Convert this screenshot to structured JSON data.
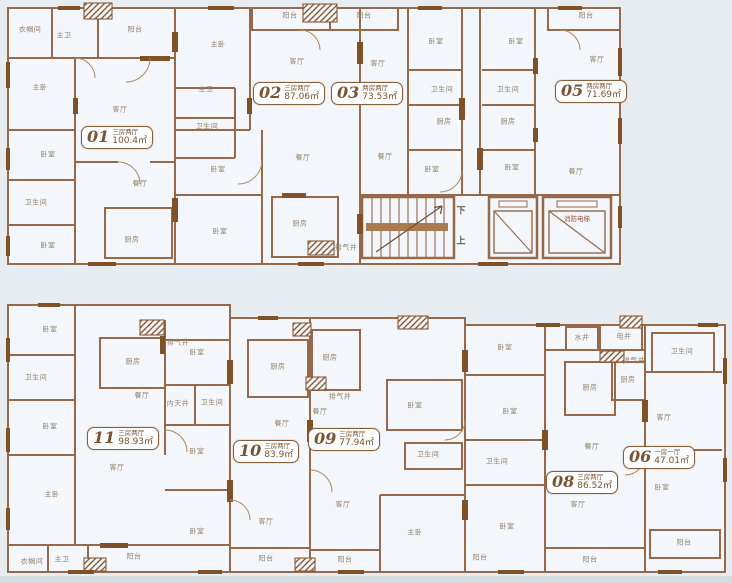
{
  "document_type": "residential-floor-plan",
  "colors": {
    "background": "#e7ecf1",
    "room_fill": "#f3f6fa",
    "wall": "#96694a",
    "wall_dark": "#7e5226",
    "label_text": "#93816b",
    "badge_border": "#8a5f38",
    "badge_text": "#7a5430"
  },
  "core": {
    "stair_down_label": "下",
    "stair_up_label": "上",
    "fire_elevator_label": "消防电梯"
  },
  "units": [
    {
      "no": "01",
      "type": "三房两厅",
      "area": "100.4㎡",
      "x": 81,
      "y": 126
    },
    {
      "no": "02",
      "type": "三房两厅",
      "area": "87.06㎡",
      "x": 253,
      "y": 82
    },
    {
      "no": "03",
      "type": "两房两厅",
      "area": "73.53㎡",
      "x": 331,
      "y": 82
    },
    {
      "no": "05",
      "type": "两房两厅",
      "area": "71.69㎡",
      "x": 555,
      "y": 80
    },
    {
      "no": "06",
      "type": "一房一厅",
      "area": "47.01㎡",
      "x": 623,
      "y": 446
    },
    {
      "no": "08",
      "type": "三房两厅",
      "area": "86.52㎡",
      "x": 546,
      "y": 471
    },
    {
      "no": "09",
      "type": "三房两厅",
      "area": "77.94㎡",
      "x": 308,
      "y": 428
    },
    {
      "no": "10",
      "type": "三房两厅",
      "area": "83.9㎡",
      "x": 233,
      "y": 440
    },
    {
      "no": "11",
      "type": "三房两厅",
      "area": "98.93㎡",
      "x": 87,
      "y": 427
    }
  ],
  "room_labels": [
    {
      "t": "衣帽间",
      "x": 30,
      "y": 30
    },
    {
      "t": "主卫",
      "x": 64,
      "y": 36
    },
    {
      "t": "阳台",
      "x": 135,
      "y": 30
    },
    {
      "t": "主卧",
      "x": 40,
      "y": 88
    },
    {
      "t": "客厅",
      "x": 120,
      "y": 110
    },
    {
      "t": "卧室",
      "x": 48,
      "y": 155
    },
    {
      "t": "卫生间",
      "x": 36,
      "y": 203
    },
    {
      "t": "餐厅",
      "x": 140,
      "y": 184
    },
    {
      "t": "卧室",
      "x": 48,
      "y": 246
    },
    {
      "t": "厨房",
      "x": 132,
      "y": 240
    },
    {
      "t": "主卧",
      "x": 218,
      "y": 45
    },
    {
      "t": "主卫",
      "x": 206,
      "y": 90
    },
    {
      "t": "卫生间",
      "x": 207,
      "y": 127
    },
    {
      "t": "卧室",
      "x": 218,
      "y": 170
    },
    {
      "t": "卧室",
      "x": 220,
      "y": 232
    },
    {
      "t": "阳台",
      "x": 290,
      "y": 16
    },
    {
      "t": "客厅",
      "x": 297,
      "y": 62
    },
    {
      "t": "餐厅",
      "x": 303,
      "y": 158
    },
    {
      "t": "厨房",
      "x": 300,
      "y": 224
    },
    {
      "t": "排气井",
      "x": 346,
      "y": 248
    },
    {
      "t": "阳台",
      "x": 364,
      "y": 16
    },
    {
      "t": "客厅",
      "x": 378,
      "y": 64
    },
    {
      "t": "餐厅",
      "x": 385,
      "y": 157
    },
    {
      "t": "卧室",
      "x": 436,
      "y": 42
    },
    {
      "t": "卫生间",
      "x": 442,
      "y": 90
    },
    {
      "t": "厨房",
      "x": 444,
      "y": 122
    },
    {
      "t": "卧室",
      "x": 432,
      "y": 170
    },
    {
      "t": "卧室",
      "x": 516,
      "y": 42
    },
    {
      "t": "卫生间",
      "x": 508,
      "y": 90
    },
    {
      "t": "厨房",
      "x": 508,
      "y": 122
    },
    {
      "t": "卧室",
      "x": 512,
      "y": 168
    },
    {
      "t": "阳台",
      "x": 586,
      "y": 16
    },
    {
      "t": "客厅",
      "x": 597,
      "y": 60
    },
    {
      "t": "餐厅",
      "x": 576,
      "y": 172
    },
    {
      "t": "排气井",
      "x": 178,
      "y": 343
    },
    {
      "t": "卧室",
      "x": 50,
      "y": 330
    },
    {
      "t": "卫生间",
      "x": 36,
      "y": 378
    },
    {
      "t": "卧室",
      "x": 50,
      "y": 427
    },
    {
      "t": "主卧",
      "x": 52,
      "y": 495
    },
    {
      "t": "厨房",
      "x": 133,
      "y": 362
    },
    {
      "t": "餐厅",
      "x": 142,
      "y": 396
    },
    {
      "t": "客厅",
      "x": 117,
      "y": 468
    },
    {
      "t": "卧室",
      "x": 197,
      "y": 353
    },
    {
      "t": "内天井",
      "x": 178,
      "y": 404
    },
    {
      "t": "卫生间",
      "x": 212,
      "y": 403
    },
    {
      "t": "卧室",
      "x": 197,
      "y": 452
    },
    {
      "t": "卧室",
      "x": 197,
      "y": 532
    },
    {
      "t": "衣帽间",
      "x": 32,
      "y": 562
    },
    {
      "t": "主卫",
      "x": 62,
      "y": 560
    },
    {
      "t": "阳台",
      "x": 134,
      "y": 557
    },
    {
      "t": "厨房",
      "x": 278,
      "y": 367
    },
    {
      "t": "餐厅",
      "x": 282,
      "y": 424
    },
    {
      "t": "客厅",
      "x": 266,
      "y": 522
    },
    {
      "t": "阳台",
      "x": 266,
      "y": 559
    },
    {
      "t": "厨房",
      "x": 330,
      "y": 358
    },
    {
      "t": "排气井",
      "x": 340,
      "y": 397
    },
    {
      "t": "餐厅",
      "x": 320,
      "y": 412
    },
    {
      "t": "客厅",
      "x": 343,
      "y": 505
    },
    {
      "t": "卧室",
      "x": 415,
      "y": 406
    },
    {
      "t": "卫生间",
      "x": 428,
      "y": 455
    },
    {
      "t": "主卧",
      "x": 415,
      "y": 533
    },
    {
      "t": "阳台",
      "x": 345,
      "y": 560
    },
    {
      "t": "卧室",
      "x": 505,
      "y": 348
    },
    {
      "t": "卧室",
      "x": 510,
      "y": 412
    },
    {
      "t": "卫生间",
      "x": 497,
      "y": 462
    },
    {
      "t": "卧室",
      "x": 507,
      "y": 527
    },
    {
      "t": "阳台",
      "x": 480,
      "y": 558
    },
    {
      "t": "水井",
      "x": 582,
      "y": 338
    },
    {
      "t": "电井",
      "x": 624,
      "y": 337
    },
    {
      "t": "排气井",
      "x": 634,
      "y": 361
    },
    {
      "t": "厨房",
      "x": 590,
      "y": 388
    },
    {
      "t": "厨房",
      "x": 628,
      "y": 380
    },
    {
      "t": "餐厅",
      "x": 592,
      "y": 447
    },
    {
      "t": "客厅",
      "x": 578,
      "y": 505
    },
    {
      "t": "阳台",
      "x": 590,
      "y": 560
    },
    {
      "t": "卫生间",
      "x": 682,
      "y": 352
    },
    {
      "t": "客厅",
      "x": 664,
      "y": 418
    },
    {
      "t": "卧室",
      "x": 662,
      "y": 488
    },
    {
      "t": "阳台",
      "x": 684,
      "y": 543
    }
  ]
}
